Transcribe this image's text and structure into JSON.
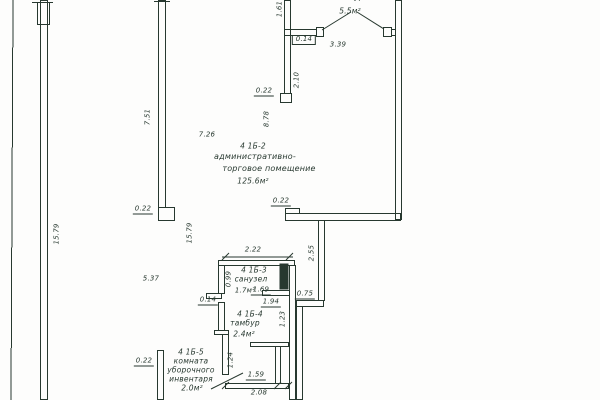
{
  "colors": {
    "ink": "#27382f",
    "paper": "#fdfdfc"
  },
  "rooms": {
    "tambour_top": {
      "name": "тамбур",
      "area": "5.5м²"
    },
    "admin": {
      "code": "4 1Б-2",
      "name_line1": "административно-",
      "name_line2": "торговое помещение",
      "area": "125.6м²"
    },
    "sanuzel": {
      "code": "4 1Б-3",
      "name": "санузел",
      "area": "1.7м²"
    },
    "tambour_inner": {
      "code": "4 1Б-4",
      "name": "тамбур",
      "area": "2.4м²"
    },
    "cleaning": {
      "code": "4 1Б-5",
      "name_line1": "комната",
      "name_line2": "уборочного",
      "name_line3": "инвентаря",
      "area": "2.0м²"
    }
  },
  "dims": {
    "v_161": "1.61",
    "h_014_top": "0.14",
    "h_339": "3.39",
    "v_210": "2.10",
    "h_022_door": "0.22",
    "v_878": "8.78",
    "v_751": "7.51",
    "h_726": "7.26",
    "h_022_mid": "0.22",
    "v_1579_left": "15.79",
    "v_1579_mid": "15.79",
    "h_022_right": "0.22",
    "v_255": "2.55",
    "h_537": "5.37",
    "h_222": "2.22",
    "v_099": "0.99",
    "h_169": "1.69",
    "h_014_bottom": "0.14",
    "h_194": "1.94",
    "h_075": "0.75",
    "v_123": "1.23",
    "h_022_bottom": "0.22",
    "v_124": "1.24",
    "h_159": "1.59",
    "h_208": "2.08"
  }
}
